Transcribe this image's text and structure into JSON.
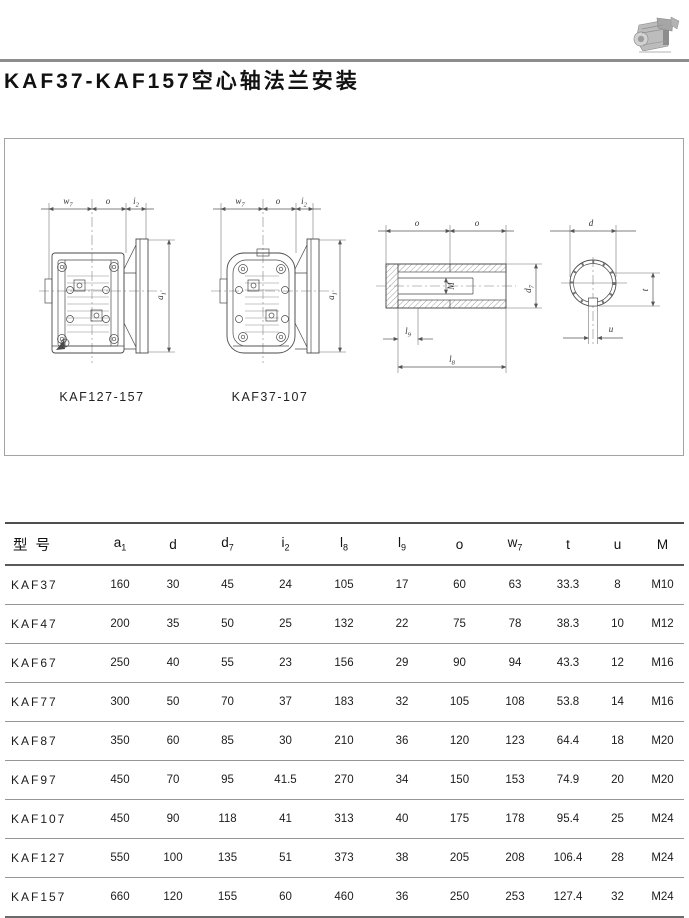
{
  "page_title": "KAF37-KAF157空心轴法兰安装",
  "figure": {
    "captions": {
      "left": "KAF127-157",
      "right": "KAF37-107"
    },
    "dims": {
      "w7": {
        "base": "w",
        "sub": "7"
      },
      "o": {
        "base": "o",
        "sub": ""
      },
      "i2": {
        "base": "i",
        "sub": "2"
      },
      "a1": {
        "base": "a",
        "sub": "1"
      },
      "M": {
        "base": "M",
        "sub": ""
      },
      "d7": {
        "base": "d",
        "sub": "7"
      },
      "l9": {
        "base": "l",
        "sub": "9"
      },
      "l8": {
        "base": "l",
        "sub": "8"
      },
      "d": {
        "base": "d",
        "sub": ""
      },
      "t": {
        "base": "t",
        "sub": ""
      },
      "u": {
        "base": "u",
        "sub": ""
      }
    }
  },
  "table": {
    "headers": [
      {
        "base": "型号",
        "sub": ""
      },
      {
        "base": "a",
        "sub": "1"
      },
      {
        "base": "d",
        "sub": ""
      },
      {
        "base": "d",
        "sub": "7"
      },
      {
        "base": "i",
        "sub": "2"
      },
      {
        "base": "l",
        "sub": "8"
      },
      {
        "base": "l",
        "sub": "9"
      },
      {
        "base": "o",
        "sub": ""
      },
      {
        "base": "w",
        "sub": "7"
      },
      {
        "base": "t",
        "sub": ""
      },
      {
        "base": "u",
        "sub": ""
      },
      {
        "base": "M",
        "sub": ""
      }
    ],
    "rows": [
      {
        "model": "KAF37",
        "values": [
          "160",
          "30",
          "45",
          "24",
          "105",
          "17",
          "60",
          "63",
          "33.3",
          "8",
          "M10"
        ]
      },
      {
        "model": "KAF47",
        "values": [
          "200",
          "35",
          "50",
          "25",
          "132",
          "22",
          "75",
          "78",
          "38.3",
          "10",
          "M12"
        ]
      },
      {
        "model": "KAF67",
        "values": [
          "250",
          "40",
          "55",
          "23",
          "156",
          "29",
          "90",
          "94",
          "43.3",
          "12",
          "M16"
        ]
      },
      {
        "model": "KAF77",
        "values": [
          "300",
          "50",
          "70",
          "37",
          "183",
          "32",
          "105",
          "108",
          "53.8",
          "14",
          "M16"
        ]
      },
      {
        "model": "KAF87",
        "values": [
          "350",
          "60",
          "85",
          "30",
          "210",
          "36",
          "120",
          "123",
          "64.4",
          "18",
          "M20"
        ]
      },
      {
        "model": "KAF97",
        "values": [
          "450",
          "70",
          "95",
          "41.5",
          "270",
          "34",
          "150",
          "153",
          "74.9",
          "20",
          "M20"
        ]
      },
      {
        "model": "KAF107",
        "values": [
          "450",
          "90",
          "118",
          "41",
          "313",
          "40",
          "175",
          "178",
          "95.4",
          "25",
          "M24"
        ]
      },
      {
        "model": "KAF127",
        "values": [
          "550",
          "100",
          "135",
          "51",
          "373",
          "38",
          "205",
          "208",
          "106.4",
          "28",
          "M24"
        ]
      },
      {
        "model": "KAF157",
        "values": [
          "660",
          "120",
          "155",
          "60",
          "460",
          "36",
          "250",
          "253",
          "127.4",
          "32",
          "M24"
        ]
      }
    ]
  }
}
